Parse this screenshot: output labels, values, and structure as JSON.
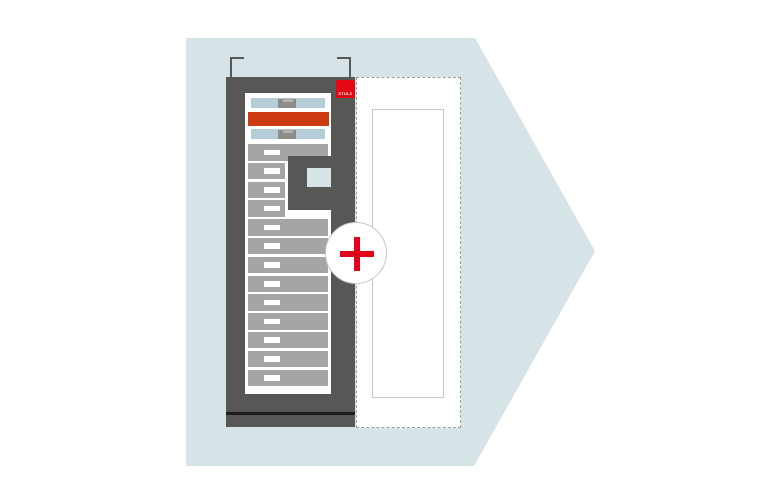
{
  "logo": {
    "text": "STULZ"
  },
  "plus_button": {
    "icon": "plus-icon",
    "glyph": "+"
  },
  "rack": {
    "drawer_count": 13,
    "narrow_drawer_indexes": [
      1,
      2,
      3
    ],
    "top_unit_count": 2,
    "highlighted_unit_count": 1
  },
  "colors": {
    "page_bg": "#ffffff",
    "arrow_bg": "#d6e3e7",
    "rack_dark": "#575756",
    "rack_inner_bg": "#ffffff",
    "drawer_gray": "#a5a5a4",
    "handle_white": "#ffffff",
    "unit_blue": "#b5cdd7",
    "unit_gray_block": "#8c8c8b",
    "unit_gray_tab": "#b2b2b1",
    "orange_unit": "#cc3c10",
    "logo_red": "#e30613",
    "plus_red": "#e2001a",
    "base_line_black": "#1d1d1b",
    "dashed_border": "#9d9d9c",
    "light_border": "#c6c6c6",
    "module_square_blue": "#d6e3e7"
  }
}
